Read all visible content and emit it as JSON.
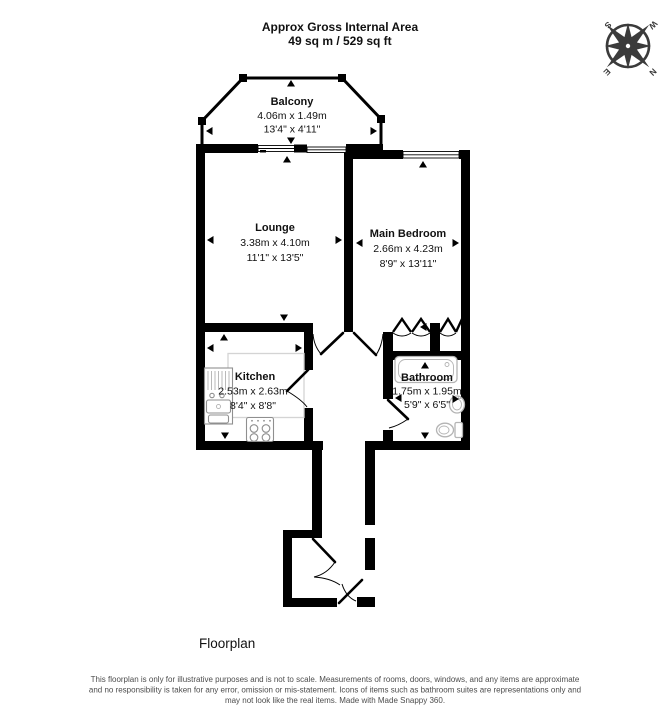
{
  "header": {
    "title": "Approx Gross Internal Area",
    "area": "49 sq m / 529 sq ft"
  },
  "compass": {
    "n": "N",
    "e": "E",
    "s": "S",
    "w": "W"
  },
  "rooms": [
    {
      "name": "Balcony",
      "metric": "4.06m x 1.49m",
      "imperial": "13'4\" x 4'11\""
    },
    {
      "name": "Lounge",
      "metric": "3.38m x 4.10m",
      "imperial": "11'1\" x 13'5\""
    },
    {
      "name": "Main Bedroom",
      "metric": "2.66m x 4.23m",
      "imperial": "8'9\" x 13'11\""
    },
    {
      "name": "Kitchen",
      "metric": "2.53m x 2.63m",
      "imperial": "8'4\" x 8'8\""
    },
    {
      "name": "Bathroom",
      "metric": "1.75m x 1.95m",
      "imperial": "5'9\" x 6'5\""
    }
  ],
  "footer": {
    "caption": "Floorplan",
    "disclaimer_lines": [
      "This floorplan is only for illustrative purposes and is not to scale. Measurements of rooms, doors, windows, and any items are approximate",
      "and no responsibility is taken for any error, omission or mis-statement. Icons of items such as bathroom suites are representations only and",
      "may not look like the real items. Made with Made Snappy 360."
    ]
  },
  "colors": {
    "background": "#ffffff",
    "walls": "#000000",
    "bath_fixtures": "#b4b4b4",
    "kitchen_fixtures": "#8f8f8f",
    "counter": "#d4d4d4",
    "compass": "#3b3b3b",
    "disclaimer_text": "#4d4d4d"
  }
}
